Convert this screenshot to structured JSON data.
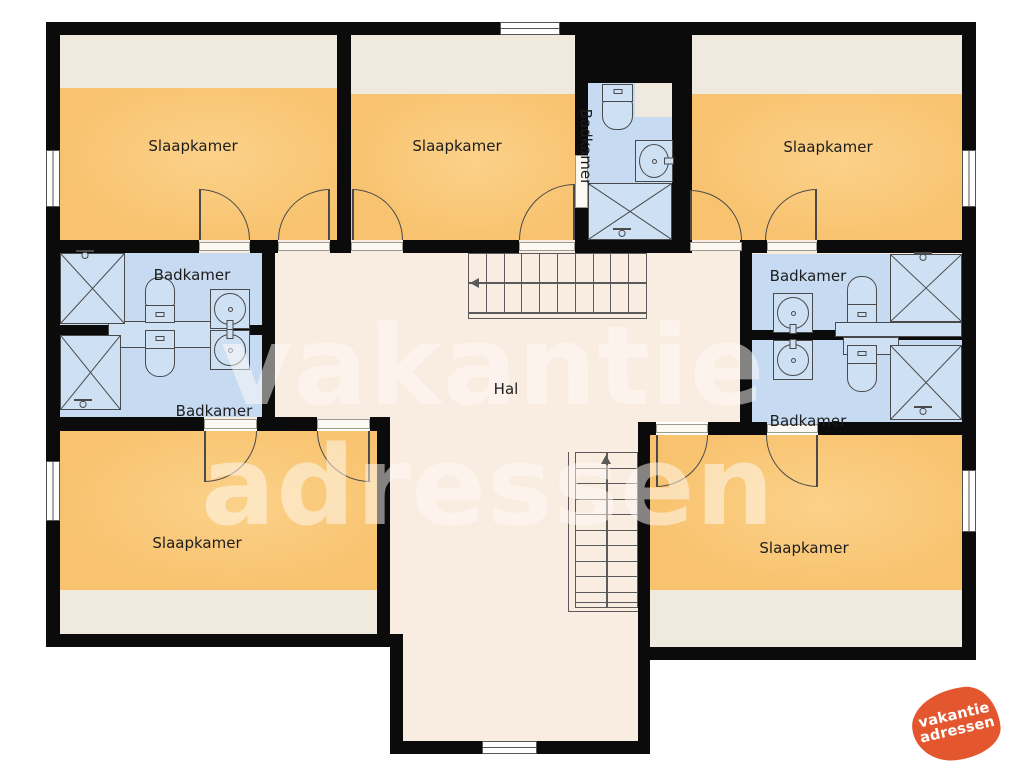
{
  "plan": {
    "hall": {
      "label": "Hal"
    },
    "bedrooms": [
      {
        "position": "top-left",
        "label": "Slaapkamer"
      },
      {
        "position": "top-middle",
        "label": "Slaapkamer"
      },
      {
        "position": "top-right",
        "label": "Slaapkamer"
      },
      {
        "position": "bottom-left",
        "label": "Slaapkamer"
      },
      {
        "position": "bottom-right",
        "label": "Slaapkamer"
      }
    ],
    "bathrooms": [
      {
        "position": "left-top",
        "label": "Badkamer"
      },
      {
        "position": "left-bottom",
        "label": "Badkamer"
      },
      {
        "position": "middle-top",
        "label": "Badkamer",
        "orientation": "vertical"
      },
      {
        "position": "right-top",
        "label": "Badkamer"
      },
      {
        "position": "right-bottom",
        "label": "Badkamer"
      }
    ],
    "colors": {
      "wall": "#0b0b0b",
      "bedroom": "#F8C26E",
      "bedroom_light": "#FBD189",
      "bedroom_edge": "#EFEADD",
      "bathroom": "#C6DBF1",
      "hall": "#F9ECE1",
      "fixture": "#CEE0F4",
      "outline": "#4a4a4a",
      "threshold": "#FCF9F3",
      "label": "#1d1d1d",
      "logo": "#E4572E",
      "watermark": "rgba(255,252,248,0.5)"
    }
  },
  "watermark": {
    "line1": "vakantie",
    "line2": "adressen"
  },
  "logo": {
    "line1": "vakantie",
    "line2": "adressen"
  },
  "icons": {
    "shower": "crossed-square",
    "shower_head": "sprayer-drop",
    "toilet": "tank-and-bowl",
    "sink": "circle-in-square",
    "stairs_up_arrow": "triangle-up",
    "stairs_down_arrow": "triangle-left"
  }
}
